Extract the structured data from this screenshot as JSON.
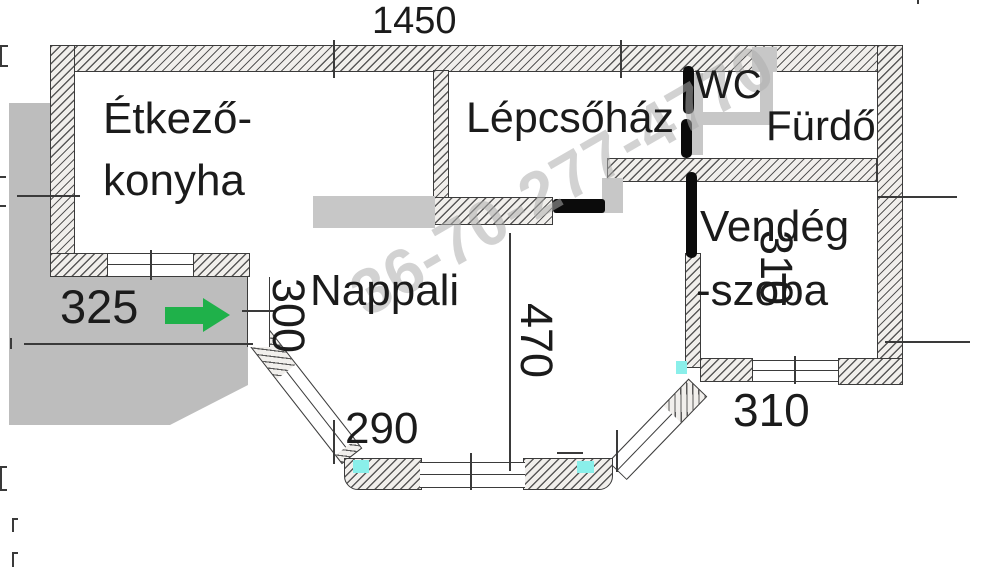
{
  "rooms": {
    "kitchen": {
      "line1": "Étkező-",
      "line2": "konyha"
    },
    "staircase": {
      "label": "Lépcsőház"
    },
    "wc": {
      "label": "WC"
    },
    "bathroom": {
      "label": "Fürdő"
    },
    "guest": {
      "line1": "Vendég",
      "line2": "-szoba"
    },
    "living": {
      "label": "Nappali"
    }
  },
  "dimensions": {
    "top_width": "1450",
    "terrace_width": "325",
    "entrance_width": "300",
    "living_depth": "470",
    "guest_depth": "310",
    "guest_width": "310",
    "bay_width": "290"
  },
  "watermark": {
    "text": "36-70-277-4770"
  },
  "colors": {
    "arrow_green": "#1fb14a",
    "sill_cyan": "#8aefea",
    "terrace_gray": "#bdbdbd",
    "partition_gray": "#c7c7c7",
    "door_black": "#0b0b0b",
    "watermark_gray": "#adadad"
  }
}
